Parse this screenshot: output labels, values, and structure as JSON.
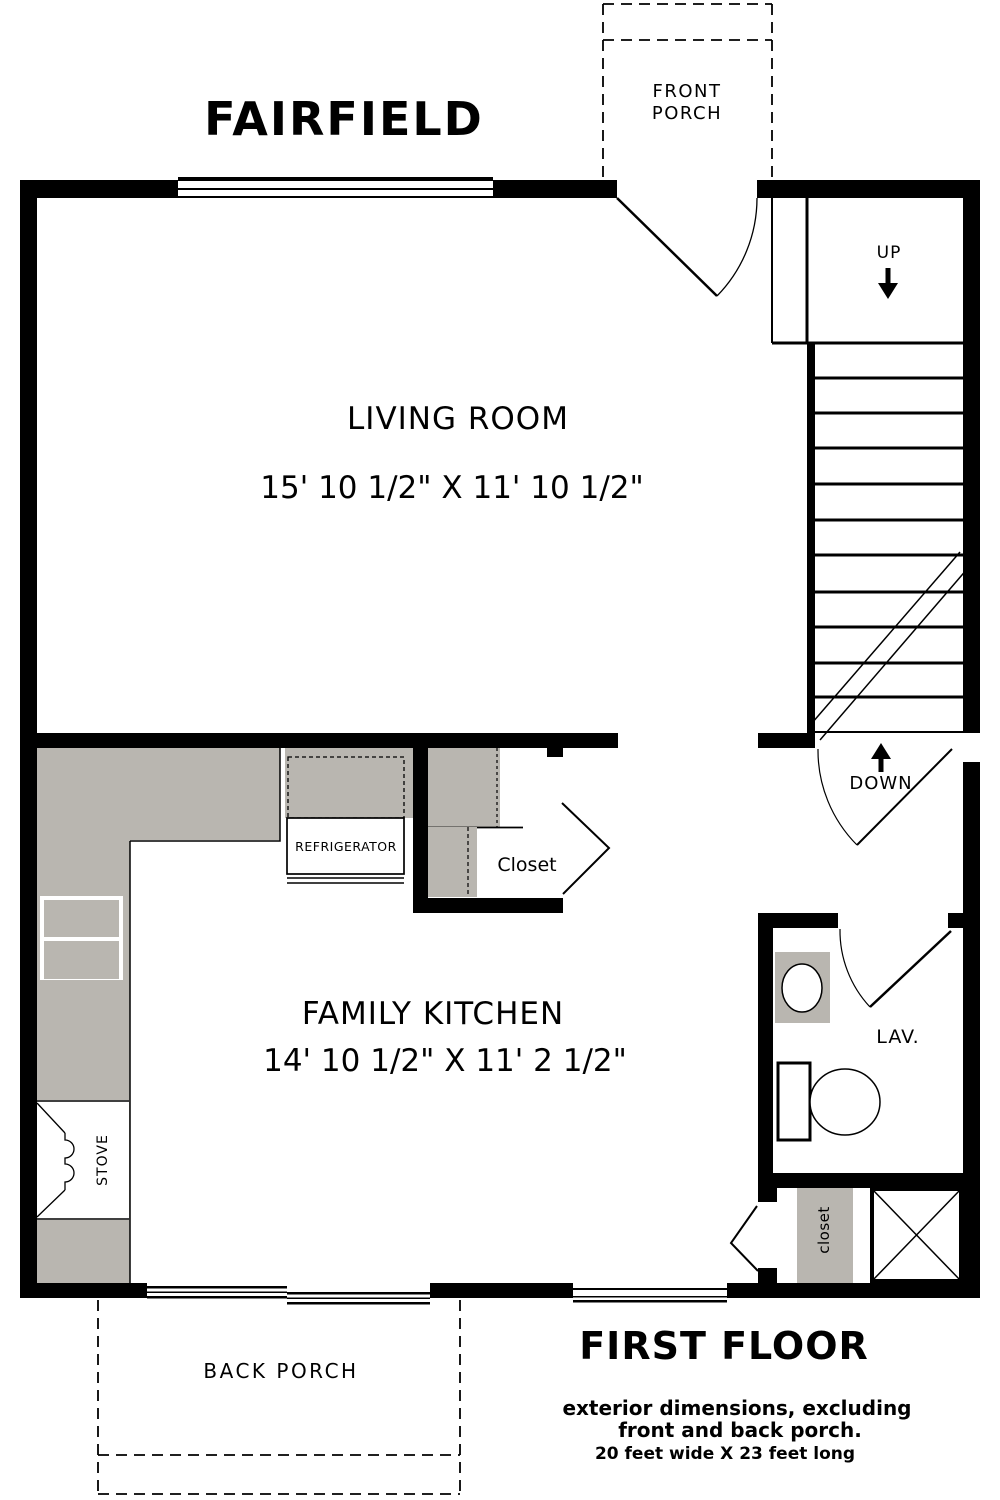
{
  "title": "FAIRFIELD",
  "front_porch": {
    "line1": "FRONT",
    "line2": "PORCH"
  },
  "living_room": {
    "name": "LIVING ROOM",
    "dims": "15' 10 1/2\"  X  11' 10 1/2\""
  },
  "kitchen": {
    "name": "FAMILY KITCHEN",
    "dims": "14' 10 1/2\"  X  11' 2 1/2\"",
    "refrigerator": "REFRIGERATOR",
    "stove": "STOVE"
  },
  "stairs": {
    "up": "UP",
    "down": "DOWN"
  },
  "closets": {
    "hall": "Closet",
    "back": "closet"
  },
  "lavatory": {
    "name": "LAV."
  },
  "back_porch": {
    "name": "BACK PORCH"
  },
  "footer": {
    "title": "FIRST FLOOR",
    "note1": "exterior dimensions, excluding",
    "note2": "front and back porch.",
    "note3": "20 feet wide  X 23 feet long"
  },
  "colors": {
    "wall": "#000000",
    "counter": "#b9b6b0",
    "background": "#ffffff"
  }
}
